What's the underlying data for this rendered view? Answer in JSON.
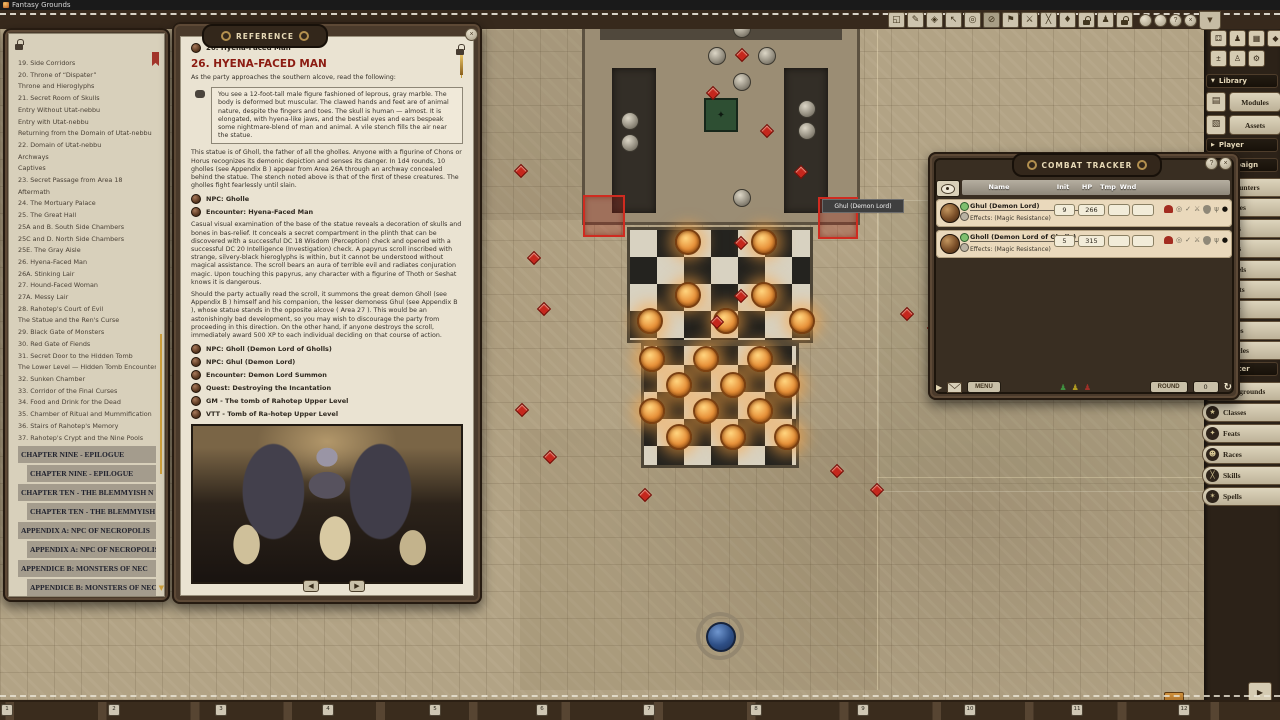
{
  "titlebar": {
    "app": "Fantasy Grounds"
  },
  "toolbar": {
    "buttons": [
      {
        "name": "fullscreen-icon",
        "glyph": "◱"
      },
      {
        "name": "draw-icon",
        "glyph": "✎"
      },
      {
        "name": "mask-icon",
        "glyph": "◈"
      },
      {
        "name": "select-icon",
        "glyph": "↖"
      },
      {
        "name": "target-icon",
        "glyph": "◎"
      },
      {
        "name": "clear-target-icon",
        "glyph": "⊘",
        "cls": "pressed"
      },
      {
        "name": "pointer-icon",
        "glyph": "⚑"
      },
      {
        "name": "attack-pointer-icon",
        "glyph": "⚔"
      },
      {
        "name": "clear-pointers-icon",
        "glyph": "╳"
      },
      {
        "name": "pin-icon",
        "glyph": "♦"
      },
      {
        "name": "token-lock-icon",
        "glyph": "",
        "cls": "ic-lock"
      },
      {
        "name": "party-vision-icon",
        "glyph": "♟"
      },
      {
        "name": "lock-icon",
        "glyph": "",
        "cls": "ic-lock"
      }
    ],
    "coins": [
      {
        "name": "hotbar-page-1",
        "glyph": ""
      },
      {
        "name": "hotbar-page-2",
        "glyph": ""
      },
      {
        "name": "hotbar-page-3",
        "glyph": "?"
      },
      {
        "name": "hotbar-page-close",
        "glyph": "×"
      }
    ],
    "filter_glyph": "▼"
  },
  "toc": {
    "items": [
      {
        "label": "19. Side Corridors"
      },
      {
        "label": "20. Throne of “Dispater”"
      },
      {
        "label": "Throne and Hieroglyphs"
      },
      {
        "label": "21. Secret Room of Skulls"
      },
      {
        "label": "Entry Without Utat-nebbu"
      },
      {
        "label": "Entry with Utat-nebbu"
      },
      {
        "label": "Returning from the Domain of Utat-nebbu"
      },
      {
        "label": "22. Domain of Utat-nebbu"
      },
      {
        "label": "Archways"
      },
      {
        "label": "Captives"
      },
      {
        "label": "23. Secret Passage from Area 18"
      },
      {
        "label": "Aftermath"
      },
      {
        "label": "24. The Mortuary Palace"
      },
      {
        "label": "25. The Great Hall"
      },
      {
        "label": "25A and B. South Side Chambers"
      },
      {
        "label": "25C and D. North Side Chambers"
      },
      {
        "label": "25E. The Gray Aisle"
      },
      {
        "label": "26. Hyena-Faced Man"
      },
      {
        "label": "26A. Stinking Lair"
      },
      {
        "label": "27. Hound-Faced Woman"
      },
      {
        "label": "27A. Messy Lair"
      },
      {
        "label": "28. Rahotep's Court of Evil"
      },
      {
        "label": "The Statue and the Ren's Curse"
      },
      {
        "label": "29. Black Gate of Monsters"
      },
      {
        "label": "30. Red Gate of Fiends"
      },
      {
        "label": "31. Secret Door to the Hidden Tomb"
      },
      {
        "label": "The Lower Level — Hidden Tomb Encounter"
      },
      {
        "label": "32. Sunken Chamber"
      },
      {
        "label": "33. Corridor of the Final Curses"
      },
      {
        "label": "34. Food and Drink for the Dead"
      },
      {
        "label": "35. Chamber of Ritual and Mummification"
      },
      {
        "label": "36. Stairs of Rahotep's Memory"
      },
      {
        "label": "37. Rahotep's Crypt and the Nine Pools"
      },
      {
        "label": "CHAPTER NINE - EPILOGUE",
        "cls": "ch"
      },
      {
        "label": "CHAPTER NINE - EPILOGUE",
        "cls": "ch ind"
      },
      {
        "label": "CHAPTER TEN - THE BLEMMYISH N",
        "cls": "ch"
      },
      {
        "label": "CHAPTER TEN - THE BLEMMYISH NO",
        "cls": "ch ind"
      },
      {
        "label": "APPENDIX A: NPC OF NECROPOLIS",
        "cls": "ch"
      },
      {
        "label": "APPENDIX A: NPC OF NECROPOLIS",
        "cls": "ch ind"
      },
      {
        "label": "APPENDICE B: MONSTERS OF NEC",
        "cls": "ch"
      },
      {
        "label": "APPENDICE B: MONSTERS OF NECRO",
        "cls": "ch ind"
      }
    ]
  },
  "reference": {
    "window_title": "Reference",
    "crumb": "26. Hyena-Faced Man",
    "heading": "26. HYENA-FACED MAN",
    "intro": "As the party approaches the southern alcove, read the following:",
    "quote": "You see a 12-foot-tall male figure fashioned of leprous, gray marble. The body is deformed but muscular. The clawed hands and feet are of animal nature, despite the fingers and toes. The skull is human — almost. It is elongated, with hyena-like jaws, and the bestial eyes and ears bespeak some nightmare-blend of man and animal. A vile stench fills the air near the statue.",
    "p2": "This statue is of Gholl, the father of all the gholles. Anyone with a figurine of Chons or Horus recognizes its demonic depiction and senses its danger. In 1d4 rounds, 10 gholles (see Appendix B ) appear from Area 26A through an archway concealed behind the statue. The stench noted above is that of the first of these creatures. The gholles fight fearlessly until slain.",
    "links1": [
      "NPC: Gholle",
      "Encounter: Hyena-Faced Man"
    ],
    "p3": "Casual visual examination of the base of the statue reveals a decoration of skulls and bones in bas-relief. It conceals a secret compartment in the plinth that can be discovered with a successful DC 18 Wisdom (Perception) check and opened with a successful DC 20 Intelligence (Investigation) check. A papyrus scroll inscribed with strange, silvery-black hieroglyphs is within, but it cannot be understood without magical assistance. The scroll bears an aura of terrible evil and radiates conjuration magic. Upon touching this papyrus, any character with a figurine of Thoth or Seshat knows it is dangerous.",
    "p4": "Should the party actually read the scroll, it summons the great demon Gholl (see Appendix B ) himself and his companion, the lesser demoness Ghul (see Appendix B ), whose statue stands in the opposite alcove ( Area 27 ). This would be an astonishingly bad development, so you may wish to discourage the party from proceeding in this direction. On the other hand, if anyone destroys the scroll, immediately award 500 XP to each individual deciding on that course of action.",
    "links2": [
      "NPC: Gholl (Demon Lord of Gholls)",
      "NPC: Ghul (Demon Lord)",
      "Encounter: Demon Lord Summon",
      "Quest: Destroying the Incantation",
      "GM - The tomb of Rahotep Upper Level",
      "VTT - Tomb of Ra-hotep Upper Level"
    ],
    "prev_glyph": "◀",
    "next_glyph": "▶"
  },
  "combat_tracker": {
    "title": "Combat Tracker",
    "help_glyph": "?",
    "close_glyph": "×",
    "columns": {
      "name": "Name",
      "init": "Init",
      "hp": "HP",
      "tmp": "Tmp",
      "wnd": "Wnd"
    },
    "rows": [
      {
        "name": "Ghul (Demon Lord)",
        "init": "9",
        "hp": "266",
        "tmp": "",
        "wnd": "",
        "effects": "Effects: (Magic Resistance)"
      },
      {
        "name": "Gholl (Demon Lord of Gholls)",
        "init": "5",
        "hp": "315",
        "tmp": "",
        "wnd": "",
        "effects": "Effects: (Magic Resistance)"
      }
    ],
    "row_icons": [
      {
        "name": "armor-icon",
        "glyph": "",
        "cls": "ic-helm"
      },
      {
        "name": "targeting-icon",
        "glyph": "◎",
        "cls": "ic-gray"
      },
      {
        "name": "visibility-icon",
        "glyph": "✓",
        "cls": "ic-gray"
      },
      {
        "name": "attack-icon",
        "glyph": "⚔",
        "cls": "ic-gray"
      },
      {
        "name": "defense-icon",
        "gly": "",
        "glyph": "",
        "cls": "ic-shield"
      },
      {
        "name": "claw-icon",
        "glyph": "ψ",
        "cls": "ic-gray"
      },
      {
        "name": "token-orb-icon",
        "glyph": "●",
        "cls": "ic-orb"
      }
    ],
    "play_glyph": "▶",
    "menu_label": "MENU",
    "round_label": "ROUND",
    "round_value": "0",
    "refresh_glyph": "↻"
  },
  "encounter": {
    "title": "08.085 Demon Lord Summon",
    "close_glyph": "×",
    "cr_label": "CR",
    "cr_value": "",
    "xp_label": "XP",
    "xp_value": "0",
    "col_token": "Token",
    "col_count": "#",
    "col_name": "Name",
    "check_glyph": "✓",
    "rows": [
      {
        "count": "1",
        "name": "Gholl (Demon Lord of Gholls)",
        "placement_label": "Placement:"
      },
      {
        "count": "1",
        "name": "Ghul (Demon Lord)",
        "placement_label": "Placement:"
      }
    ],
    "row_icons": [
      {
        "name": "token-link-icon",
        "glyph": "",
        "cls": "ring-g"
      },
      {
        "name": "npc-link-icon",
        "glyph": "♜",
        "cls": "ic-gray2"
      },
      {
        "name": "record-orb-icon",
        "glyph": "●",
        "cls": "ic-orb2"
      }
    ]
  },
  "sidebar": {
    "tool_label": "Tool",
    "library_label": "Library",
    "player_label": "Player",
    "campaign_label": "Campaign",
    "character_label": "Character",
    "tool_icons": [
      {
        "name": "tool-dice-icon",
        "glyph": "⚃"
      },
      {
        "name": "tool-party-icon",
        "glyph": "♟"
      },
      {
        "name": "tool-calendar-icon",
        "glyph": "▦"
      },
      {
        "name": "tool-die-icon",
        "glyph": "◆"
      },
      {
        "name": "tool-modifiers-icon",
        "glyph": "±"
      },
      {
        "name": "tool-identities-icon",
        "glyph": "♙"
      },
      {
        "name": "tool-options-icon",
        "glyph": "⚙"
      }
    ],
    "library_buttons": [
      {
        "name": "sidebar-modules-button",
        "label": "Modules",
        "glyph": "▤"
      },
      {
        "name": "sidebar-assets-button",
        "label": "Assets",
        "glyph": "▧"
      }
    ],
    "campaign_tabs": [
      "Encounters",
      "Images",
      "Items",
      "NPCs",
      "Parcels",
      "Quests",
      "Story",
      "Tables",
      "Vehicles"
    ],
    "character_tabs": [
      {
        "label": "Backgrounds",
        "glyph": "▤"
      },
      {
        "label": "Classes",
        "glyph": "★"
      },
      {
        "label": "Feats",
        "glyph": "✦"
      },
      {
        "label": "Races",
        "glyph": "☻"
      },
      {
        "label": "Skills",
        "glyph": "╳"
      },
      {
        "label": "Spells",
        "glyph": "✶"
      }
    ],
    "expand_glyph": "▼",
    "collapse_glyph": "▶"
  },
  "chat": {
    "line1": "Core RPG ruleset (2023-04-25) for Fantasy Grounds",
    "line2": "Copyright 2023 Smiteworks USA, LLC",
    "identity": "GM",
    "caret": "▾",
    "chat_label": "Chat"
  },
  "dice": {
    "modifier_value": "0",
    "modifier_label": "Modifier",
    "buttons": [
      "ADV",
      "+2",
      "+5",
      "DIS",
      "-2",
      "-5"
    ],
    "dice": [
      {
        "name": "die-d20",
        "label": "20",
        "cls": "d20",
        "x": 110,
        "y": 8
      },
      {
        "name": "die-d12",
        "label": "12",
        "cls": "d12",
        "x": 141,
        "y": 9
      },
      {
        "name": "die-d10",
        "label": "10",
        "cls": "d10",
        "x": 169,
        "y": 11
      },
      {
        "name": "die-d8",
        "label": "8",
        "cls": "d8",
        "x": 200,
        "y": 8
      },
      {
        "name": "die-d6",
        "label": "6.",
        "cls": "d6",
        "x": 234,
        "y": 12
      },
      {
        "name": "die-d4",
        "label": "4",
        "cls": "d4",
        "x": 262,
        "y": 10
      },
      {
        "name": "die-d100",
        "label": "00",
        "cls": "d100",
        "x": 295,
        "y": 9
      }
    ]
  },
  "hotkeys": {
    "slots": [
      {
        "label": "1",
        "x": 1
      },
      {
        "label": "2",
        "x": 108
      },
      {
        "label": "3",
        "x": 215
      },
      {
        "label": "4",
        "x": 322
      },
      {
        "label": "5",
        "x": 429
      },
      {
        "label": "6",
        "x": 536
      },
      {
        "label": "7",
        "x": 643
      },
      {
        "label": "8",
        "x": 750
      },
      {
        "label": "9",
        "x": 857
      },
      {
        "label": "10",
        "x": 964
      },
      {
        "label": "11",
        "x": 1071
      },
      {
        "label": "12",
        "x": 1178
      }
    ]
  },
  "map": {
    "tooltip": "Ghul (Demon Lord)",
    "statue_glyph": "✦",
    "orange_tokens": [
      {
        "x": 675,
        "y": 219
      },
      {
        "x": 751,
        "y": 219
      },
      {
        "x": 675,
        "y": 272
      },
      {
        "x": 751,
        "y": 272
      },
      {
        "x": 637,
        "y": 298
      },
      {
        "x": 713,
        "y": 298
      },
      {
        "x": 789,
        "y": 298
      },
      {
        "x": 639,
        "y": 336
      },
      {
        "x": 693,
        "y": 336
      },
      {
        "x": 747,
        "y": 336
      },
      {
        "x": 666,
        "y": 362
      },
      {
        "x": 720,
        "y": 362
      },
      {
        "x": 774,
        "y": 362
      },
      {
        "x": 639,
        "y": 388
      },
      {
        "x": 693,
        "y": 388
      },
      {
        "x": 747,
        "y": 388
      },
      {
        "x": 666,
        "y": 414
      },
      {
        "x": 720,
        "y": 414
      },
      {
        "x": 774,
        "y": 414
      }
    ],
    "red_markers": [
      {
        "x": 736,
        "y": 228
      },
      {
        "x": 736,
        "y": 281
      },
      {
        "x": 712,
        "y": 307
      },
      {
        "x": 516,
        "y": 156
      },
      {
        "x": 529,
        "y": 243
      },
      {
        "x": 539,
        "y": 294
      },
      {
        "x": 517,
        "y": 395
      },
      {
        "x": 545,
        "y": 442
      },
      {
        "x": 640,
        "y": 480
      },
      {
        "x": 832,
        "y": 456
      },
      {
        "x": 872,
        "y": 475
      },
      {
        "x": 902,
        "y": 299
      },
      {
        "x": 929,
        "y": 313
      },
      {
        "x": 708,
        "y": 78
      },
      {
        "x": 762,
        "y": 116
      },
      {
        "x": 796,
        "y": 157
      },
      {
        "x": 737,
        "y": 40
      }
    ],
    "gray_tokens": [
      {
        "x": 733,
        "y": 10
      },
      {
        "x": 708,
        "y": 37
      },
      {
        "x": 758,
        "y": 37
      },
      {
        "x": 733,
        "y": 63
      },
      {
        "x": 621,
        "y": 102
      },
      {
        "x": 621,
        "y": 124
      },
      {
        "x": 798,
        "y": 90
      },
      {
        "x": 798,
        "y": 112
      },
      {
        "x": 733,
        "y": 179
      }
    ]
  }
}
